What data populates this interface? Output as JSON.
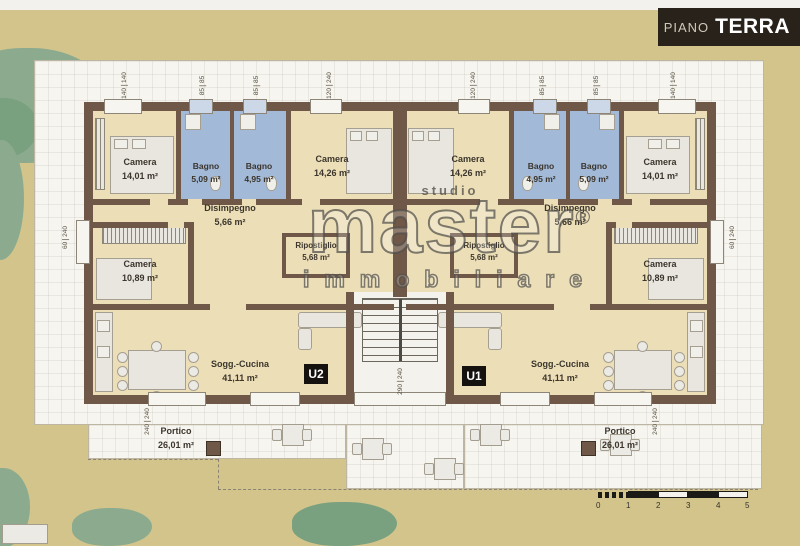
{
  "banner": {
    "prefix": "PIANO",
    "title": "TERRA"
  },
  "watermark": {
    "studio": "studio",
    "brand": "master",
    "registered": "®",
    "sub": "immobiliare"
  },
  "unit_labels": {
    "left": "U2",
    "right": "U1"
  },
  "rooms": [
    {
      "name": "Camera",
      "area": "14,01 m²"
    },
    {
      "name": "Bagno",
      "area": "5,09 m²"
    },
    {
      "name": "Bagno",
      "area": "4,95 m²"
    },
    {
      "name": "Camera",
      "area": "14,26 m²"
    },
    {
      "name": "Camera",
      "area": "14,26 m²"
    },
    {
      "name": "Bagno",
      "area": "4,95 m²"
    },
    {
      "name": "Bagno",
      "area": "5,09 m²"
    },
    {
      "name": "Camera",
      "area": "14,01 m²"
    },
    {
      "name": "Disimpegno",
      "area": "5,66 m²"
    },
    {
      "name": "Disimpegno",
      "area": "5,66 m²"
    },
    {
      "name": "Camera",
      "area": "10,89 m²"
    },
    {
      "name": "Camera",
      "area": "10,89 m²"
    },
    {
      "name": "Ripostiglio",
      "area": "5,68 m²"
    },
    {
      "name": "Ripostiglio",
      "area": "5,68 m²"
    },
    {
      "name": "Sogg.-Cucina",
      "area": "41,11 m²"
    },
    {
      "name": "Sogg.-Cucina",
      "area": "41,11 m²"
    },
    {
      "name": "Portico",
      "area": "26,01 m²"
    },
    {
      "name": "Portico",
      "area": "26,01 m²"
    }
  ],
  "dims": [
    {
      "a": "140",
      "b": "140"
    },
    {
      "a": "85",
      "b": "85"
    },
    {
      "a": "85",
      "b": "85"
    },
    {
      "a": "120",
      "b": "240"
    },
    {
      "a": "120",
      "b": "240"
    },
    {
      "a": "85",
      "b": "85"
    },
    {
      "a": "85",
      "b": "85"
    },
    {
      "a": "140",
      "b": "140"
    },
    {
      "a": "60",
      "b": "240"
    },
    {
      "a": "60",
      "b": "240"
    },
    {
      "a": "240",
      "b": "240"
    },
    {
      "a": "240",
      "b": "240"
    },
    {
      "a": "290",
      "b": "240"
    }
  ],
  "scale_bar": {
    "ticks": [
      "0",
      "1",
      "2",
      "3",
      "4",
      "5"
    ]
  },
  "colors": {
    "ground": "#d3c48c",
    "paper": "#f7f5f0",
    "wall": "#6f5847",
    "bath_blue": "#a2b9d8",
    "room_tan": "#ecdfb8",
    "banner_bg": "#29221b",
    "green": "#8cab8e"
  }
}
